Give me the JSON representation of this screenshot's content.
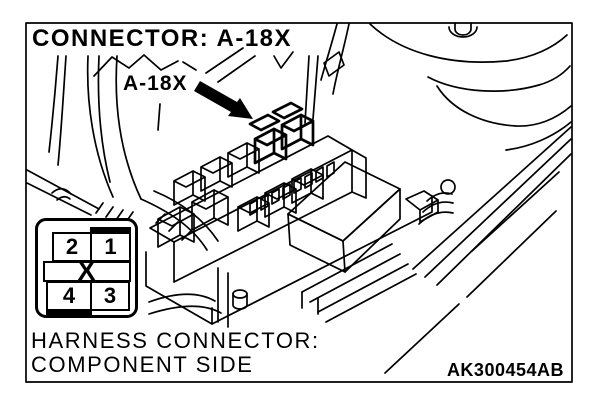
{
  "figure": {
    "title": "CONNECTOR: A-18X",
    "callout": {
      "label": "A-18X"
    },
    "caption": {
      "line1": "HARNESS CONNECTOR:",
      "line2": "COMPONENT SIDE"
    },
    "code": "AK300454AB",
    "colors": {
      "line": "#000000",
      "background": "#ffffff"
    }
  },
  "pin_diagram": {
    "rows": [
      [
        "2",
        "1"
      ],
      [
        "4",
        "3"
      ]
    ],
    "center_mark": "X"
  }
}
